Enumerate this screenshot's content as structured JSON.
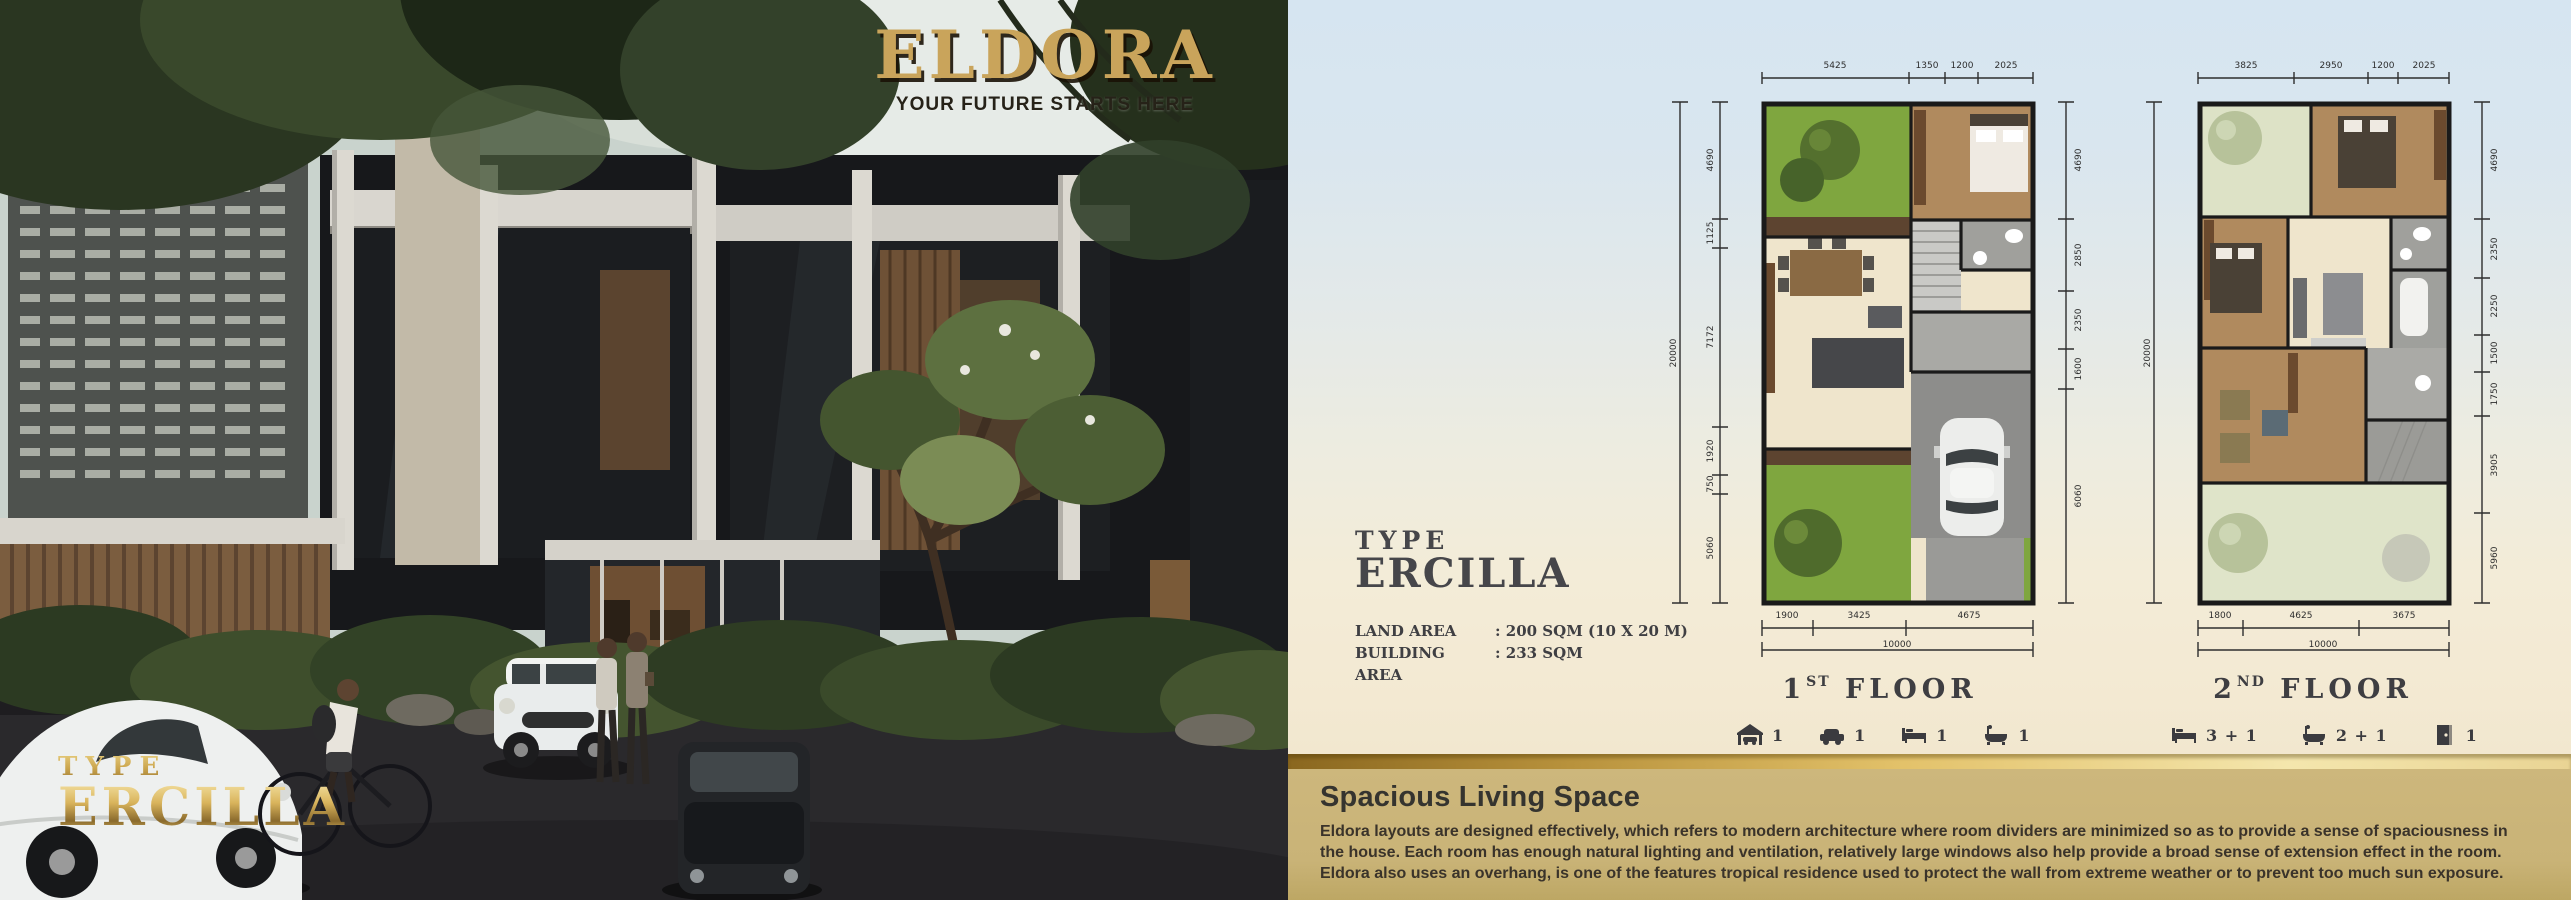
{
  "brand": {
    "name": "ELDORA",
    "tagline": "YOUR FUTURE STARTS HERE"
  },
  "photo_overlay": {
    "type_label": "TYPE",
    "type_name": "ERCILLA"
  },
  "spec": {
    "type_label": "TYPE",
    "type_name": "ERCILLA",
    "rows": [
      {
        "label": "LAND AREA",
        "value": ": 200 SQM (10 X 20 M)"
      },
      {
        "label": "BUILDING AREA",
        "value": ": 233 SQM"
      }
    ]
  },
  "plans": [
    {
      "ordinal": "1",
      "suffix": "ST",
      "floor_word": "FLOOR",
      "top_dims": [
        "5425",
        "1350",
        "1200",
        "2025"
      ],
      "left_total": "20000",
      "left_dims": [
        "4690",
        "1125",
        "7172",
        "1920",
        "750",
        "5060"
      ],
      "right_dims": [
        "4690",
        "2850",
        "2350",
        "1600",
        "6060"
      ],
      "bottom_dims": [
        "1900",
        "3425",
        "4675"
      ],
      "bottom_total": "10000",
      "features": [
        {
          "icon": "carport-icon",
          "count": "1"
        },
        {
          "icon": "car-icon",
          "count": "1"
        },
        {
          "icon": "bed-icon",
          "count": "1"
        },
        {
          "icon": "bath-icon",
          "count": "1"
        }
      ]
    },
    {
      "ordinal": "2",
      "suffix": "ND",
      "floor_word": "FLOOR",
      "top_dims": [
        "3825",
        "2950",
        "1200",
        "2025"
      ],
      "left_total": "20000",
      "right_dims": [
        "4690",
        "2350",
        "2250",
        "1500",
        "1750",
        "3905",
        "5960"
      ],
      "bottom_dims": [
        "1800",
        "4625",
        "3675"
      ],
      "bottom_total": "10000",
      "features": [
        {
          "icon": "bed-icon",
          "count": "3 + 1"
        },
        {
          "icon": "bath-icon",
          "count": "2 + 1"
        },
        {
          "icon": "door-icon",
          "count": "1"
        }
      ]
    }
  ],
  "description": {
    "heading": "Spacious Living Space",
    "body": "Eldora layouts are designed effectively, which refers to modern architecture where room dividers are minimized so as to provide a sense of spaciousness in the house. Each room has enough natural lighting and ventilation, relatively large windows also help provide a broad sense of extension effect in the room. Eldora also uses an overhang, is one of the features tropical residence used to protect the wall from extreme weather or to prevent too much sun exposure."
  },
  "colors": {
    "gold": "#c9a45b",
    "gold_dark": "#8a6a2c",
    "panel_top": "#d6e5f1",
    "panel_cream": "#f3e9d2",
    "ribbon_gold": "#e3c26a",
    "description_bg": "#c9b377",
    "heading_dark": "#46464a",
    "plan_green": "#7fa63f",
    "plan_wood": "#b08a5e",
    "plan_sage": "#dde2c6"
  }
}
